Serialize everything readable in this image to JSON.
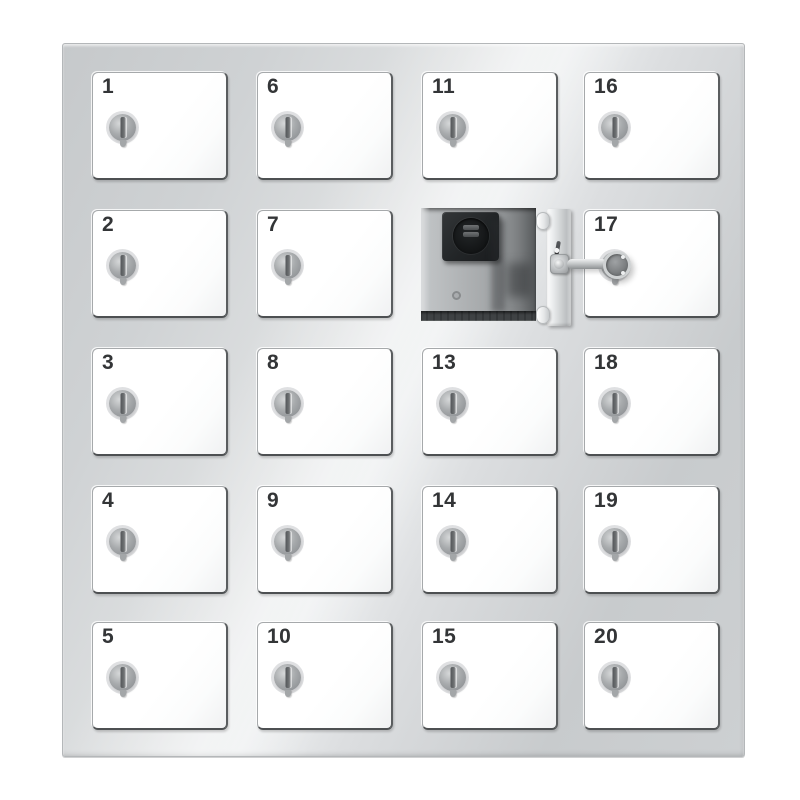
{
  "cabinet": {
    "type": "key-locker",
    "columns": 4,
    "rows": 5,
    "doors": [
      {
        "label": "1",
        "col": 0,
        "row": 0,
        "state": "closed"
      },
      {
        "label": "2",
        "col": 0,
        "row": 1,
        "state": "closed"
      },
      {
        "label": "3",
        "col": 0,
        "row": 2,
        "state": "closed"
      },
      {
        "label": "4",
        "col": 0,
        "row": 3,
        "state": "closed"
      },
      {
        "label": "5",
        "col": 0,
        "row": 4,
        "state": "closed"
      },
      {
        "label": "6",
        "col": 1,
        "row": 0,
        "state": "closed"
      },
      {
        "label": "7",
        "col": 1,
        "row": 1,
        "state": "closed"
      },
      {
        "label": "8",
        "col": 1,
        "row": 2,
        "state": "closed"
      },
      {
        "label": "9",
        "col": 1,
        "row": 3,
        "state": "closed"
      },
      {
        "label": "10",
        "col": 1,
        "row": 4,
        "state": "closed"
      },
      {
        "label": "11",
        "col": 2,
        "row": 0,
        "state": "closed"
      },
      {
        "label": "",
        "col": 2,
        "row": 1,
        "state": "open",
        "key_in_lock": true
      },
      {
        "label": "13",
        "col": 2,
        "row": 2,
        "state": "closed"
      },
      {
        "label": "14",
        "col": 2,
        "row": 3,
        "state": "closed"
      },
      {
        "label": "15",
        "col": 2,
        "row": 4,
        "state": "closed"
      },
      {
        "label": "16",
        "col": 3,
        "row": 0,
        "state": "closed"
      },
      {
        "label": "17",
        "col": 3,
        "row": 1,
        "state": "closed"
      },
      {
        "label": "18",
        "col": 3,
        "row": 2,
        "state": "closed"
      },
      {
        "label": "19",
        "col": 3,
        "row": 3,
        "state": "closed"
      },
      {
        "label": "20",
        "col": 3,
        "row": 4,
        "state": "closed"
      }
    ],
    "open_compartment": {
      "grid_position": "column 3, row 2",
      "door_state": "open",
      "key_inserted_in_door_lock": true,
      "key_points_toward_door": "17",
      "interior_features": [
        "charging-module-with-two-ports",
        "cable-grommet-hole",
        "ribbed-floor-mat",
        "door-hinges"
      ]
    },
    "palette": {
      "frame": "#cdd0d2",
      "frame_light": "#eef0f1",
      "frame_dark": "#c6c9cb",
      "door": "#ffffff",
      "number": "#333537",
      "lock_body": "#a8abad",
      "lock_slot": "#6a6d6f",
      "interior_wall": "#b3b6b8",
      "module": "#222527",
      "floor": "#3f4244",
      "key_metal": "#c6c9ca",
      "key_head": "#7d8082"
    }
  }
}
